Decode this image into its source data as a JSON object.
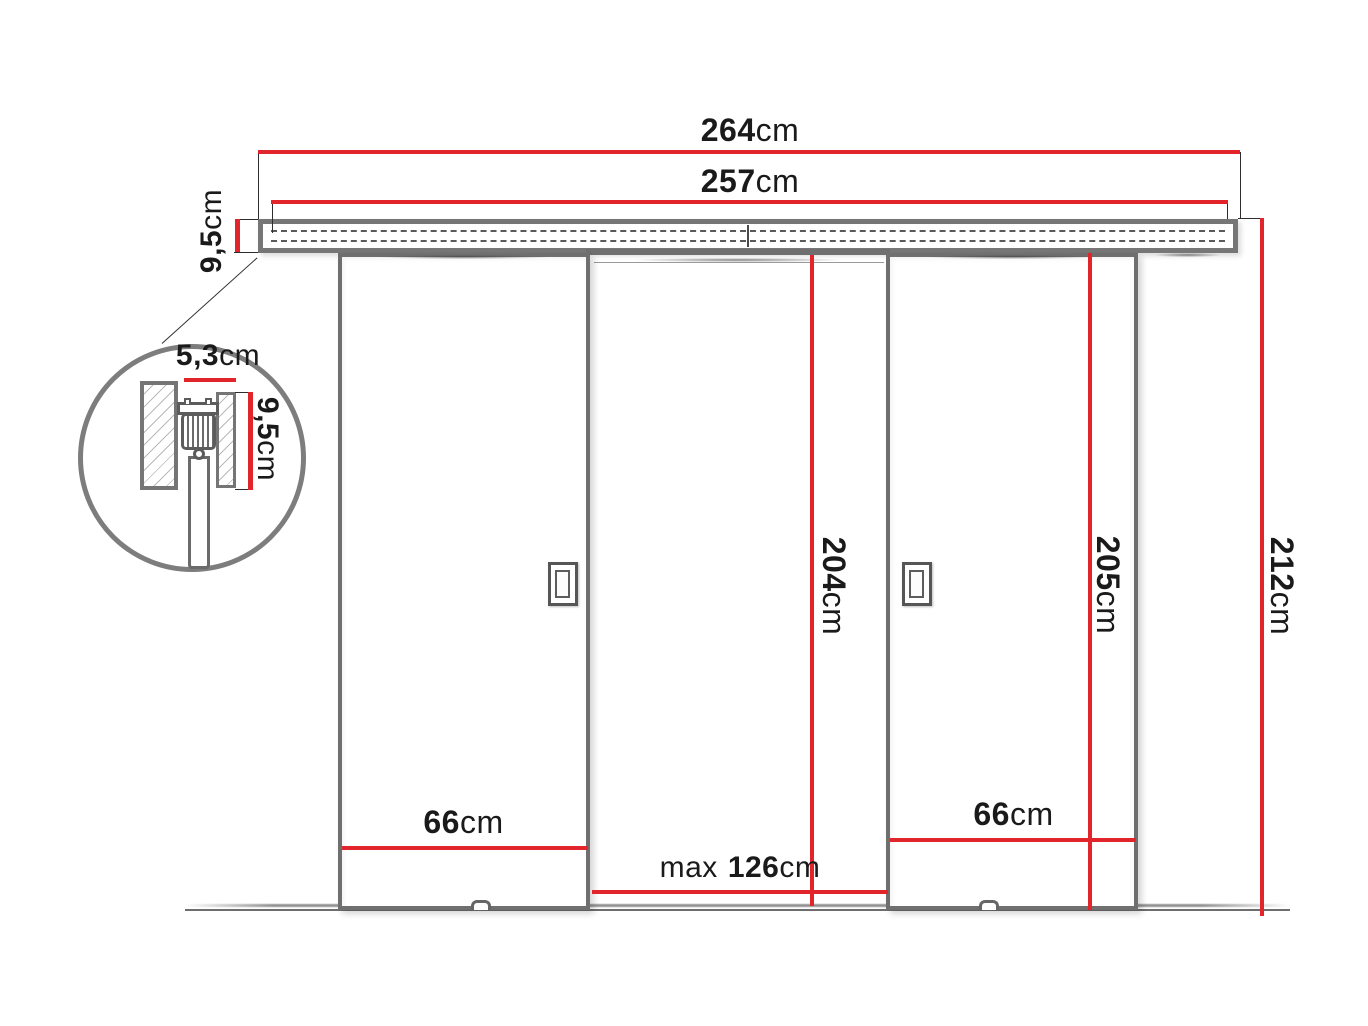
{
  "dimension_color": "#e2252b",
  "outline_color": "#6f6f6f",
  "dims": {
    "total_width": {
      "value": "264",
      "unit": "cm"
    },
    "rail_length": {
      "value": "257",
      "unit": "cm"
    },
    "rail_height": {
      "value": "9,5",
      "unit": "cm"
    },
    "detail_width": {
      "value": "5,3",
      "unit": "cm"
    },
    "detail_height": {
      "value": "9,5",
      "unit": "cm"
    },
    "passage_height": {
      "value": "204",
      "unit": "cm"
    },
    "door_height": {
      "value": "205",
      "unit": "cm"
    },
    "total_height": {
      "value": "212",
      "unit": "cm"
    },
    "left_door_width": {
      "value": "66",
      "unit": "cm"
    },
    "right_door_width": {
      "value": "66",
      "unit": "cm"
    },
    "max_passage_width": {
      "prefix": "max",
      "value": "126",
      "unit": "cm"
    }
  }
}
